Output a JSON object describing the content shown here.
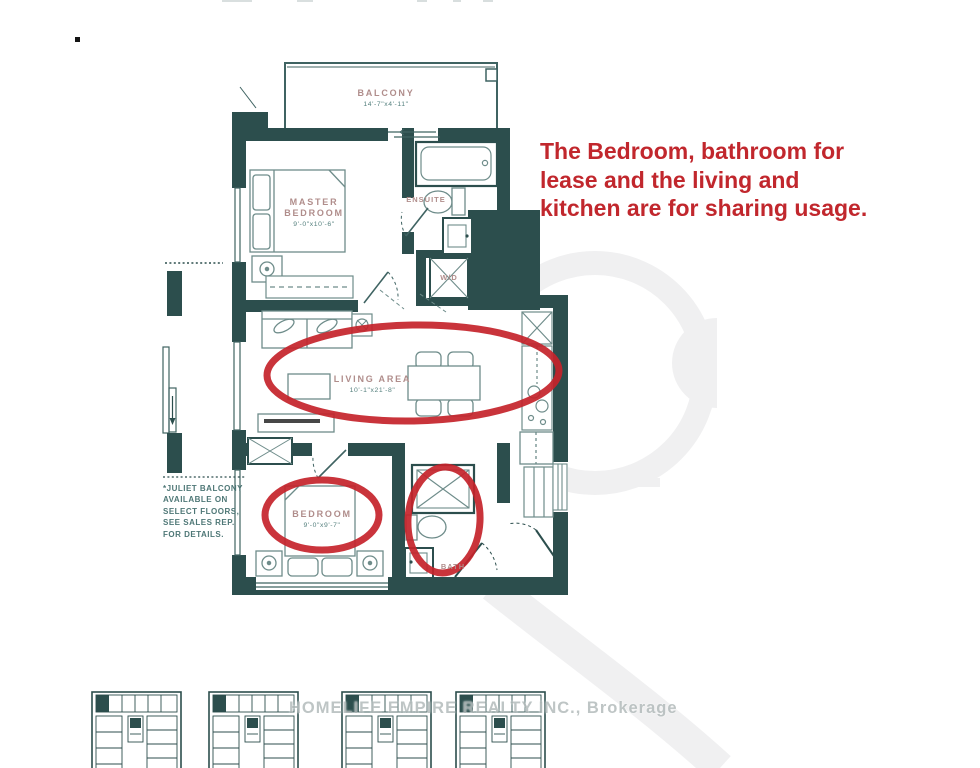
{
  "annotation": {
    "color": "#c1272d",
    "line1": "The Bedroom, bathroom for",
    "line2": "lease and the living and",
    "line3": "kitchen are for sharing usage."
  },
  "floorplan": {
    "wall_color": "#2c4e4d",
    "room_label_color": "#b08d8b",
    "dimension_color": "#55807e",
    "highlight_color": "#c5232b",
    "rooms": {
      "balcony": {
        "label": "BALCONY",
        "dims": "14'-7\"x4'-11\""
      },
      "master_bedroom": {
        "label_line1": "MASTER",
        "label_line2": "BEDROOM",
        "dims": "9'-0\"x10'-6\""
      },
      "ensuite": {
        "label": "ENSUITE"
      },
      "laundry": {
        "label": "W/D"
      },
      "living_area": {
        "label": "LIVING AREA",
        "dims": "10'-1\"x21'-8\""
      },
      "bedroom": {
        "label": "BEDROOM",
        "dims": "9'-0\"x9'-7\""
      },
      "bath": {
        "label": "BATH"
      }
    },
    "footnote": {
      "line1": "*JULIET BALCONY",
      "line2": "AVAILABLE ON",
      "line3": "SELECT FLOORS,",
      "line4": "SEE SALES REP.",
      "line5": "FOR DETAILS."
    }
  },
  "watermark": {
    "brokerage": "HOMELIFE EMPIRE REALTY INC., Brokerage",
    "logo_color": "#f0f0f1"
  }
}
